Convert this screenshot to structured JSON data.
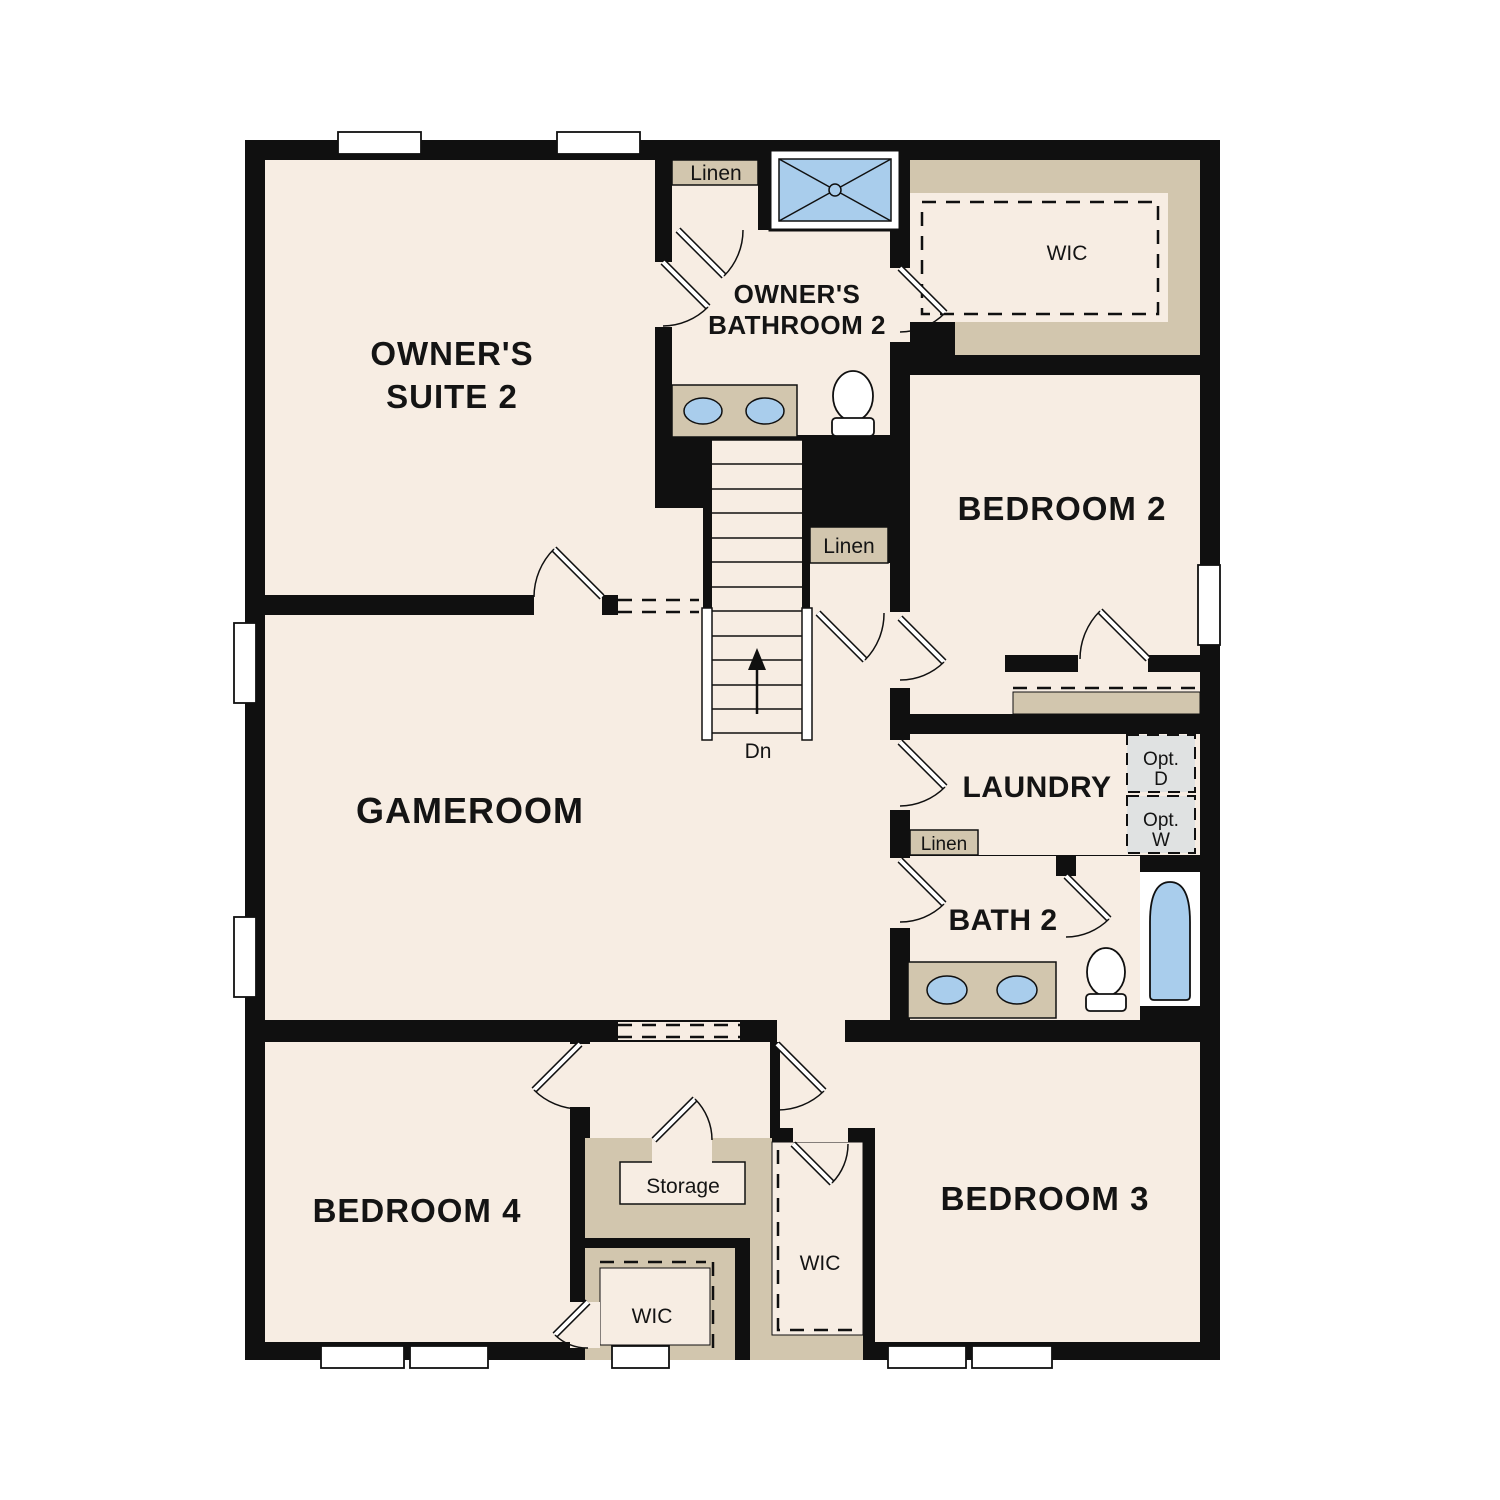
{
  "floorplan": {
    "floor": "second",
    "rooms": [
      "Owner's Suite 2",
      "Owner's Bathroom 2",
      "WIC",
      "Bedroom 2",
      "Gameroom",
      "Laundry",
      "Bath 2",
      "Bedroom 4",
      "Bedroom 3",
      "Storage"
    ],
    "labels": {
      "owners_suite_l1": "OWNER'S",
      "owners_suite_l2": "SUITE 2",
      "owners_bath_l1": "OWNER'S",
      "owners_bath_l2": "BATHROOM 2",
      "wic_top": "WIC",
      "wic_bed4": "WIC",
      "wic_bed3": "WIC",
      "bedroom2": "BEDROOM 2",
      "gameroom": "GAMEROOM",
      "laundry": "LAUNDRY",
      "bath2": "BATH 2",
      "bedroom4": "BEDROOM 4",
      "bedroom3": "BEDROOM 3",
      "storage": "Storage",
      "linen_top": "Linen",
      "linen_hall": "Linen",
      "linen_bath": "Linen",
      "stairs_direction": "Dn",
      "opt_dryer_l1": "Opt.",
      "opt_dryer_l2": "D",
      "opt_washer_l1": "Opt.",
      "opt_washer_l2": "W"
    },
    "colors": {
      "wall": "#101010",
      "floor": "#f7ede3",
      "closet_tan": "#d2c6ae",
      "fixture_blue": "#a9cdec",
      "appliance_gray": "#e0e2e2",
      "window_white": "#ffffff"
    }
  }
}
